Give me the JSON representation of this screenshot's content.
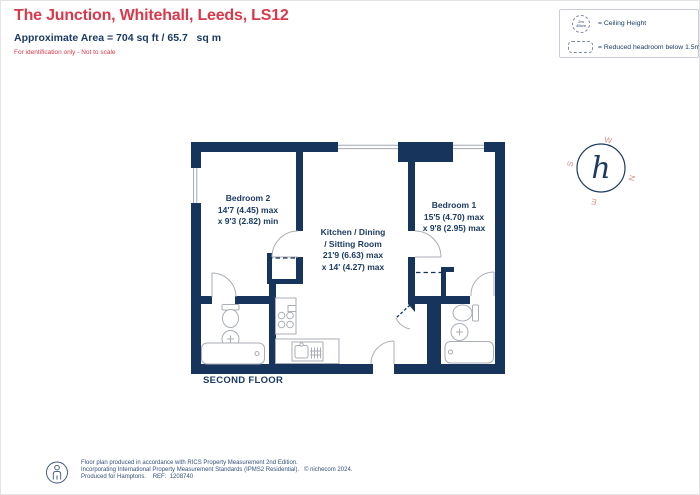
{
  "header": {
    "title": "The Junction, Whitehall, Leeds, LS12",
    "area_line": "Approximate Area = 704 sq ft / 65.7   sq m",
    "disclaimer": "For identification only - Not to scale"
  },
  "legend": {
    "ceiling_symbol": "2m 45cm",
    "ceiling_label": "= Ceiling Height",
    "reduced_label": "= Reduced headroom below 1.5m"
  },
  "compass": {
    "n": "N",
    "e": "E",
    "s": "S",
    "w": "W",
    "glyph": "h"
  },
  "floorplan": {
    "floor_label": "SECOND FLOOR",
    "rooms": [
      {
        "name": "Bedroom 2",
        "dim1": "14'7 (4.45) max",
        "dim2": "x 9'3 (2.82) min"
      },
      {
        "name": "Kitchen / Dining",
        "name2": "/ Sitting Room",
        "dim1": "21'9 (6.63) max",
        "dim2": "x 14' (4.27) max"
      },
      {
        "name": "Bedroom 1",
        "dim1": "15'5 (4.70) max",
        "dim2": "x 9'8 (2.95) max"
      }
    ]
  },
  "footer": {
    "line1": "Floor plan produced in accordance with RICS Property Measurement 2nd Edition.",
    "line2": "Incorporating International Property Measurement Standards (IPMS2 Residential).",
    "copyright": "© nichecom 2024.",
    "line3": "Produced for Hamptons.    REF:  1208740"
  },
  "colors": {
    "wall_navy": "#17355c",
    "title_red": "#d9394b",
    "text_navy": "#1c3b63",
    "compass_letter_red": "#d99090",
    "fixture_gray": "#a9aeb7"
  }
}
